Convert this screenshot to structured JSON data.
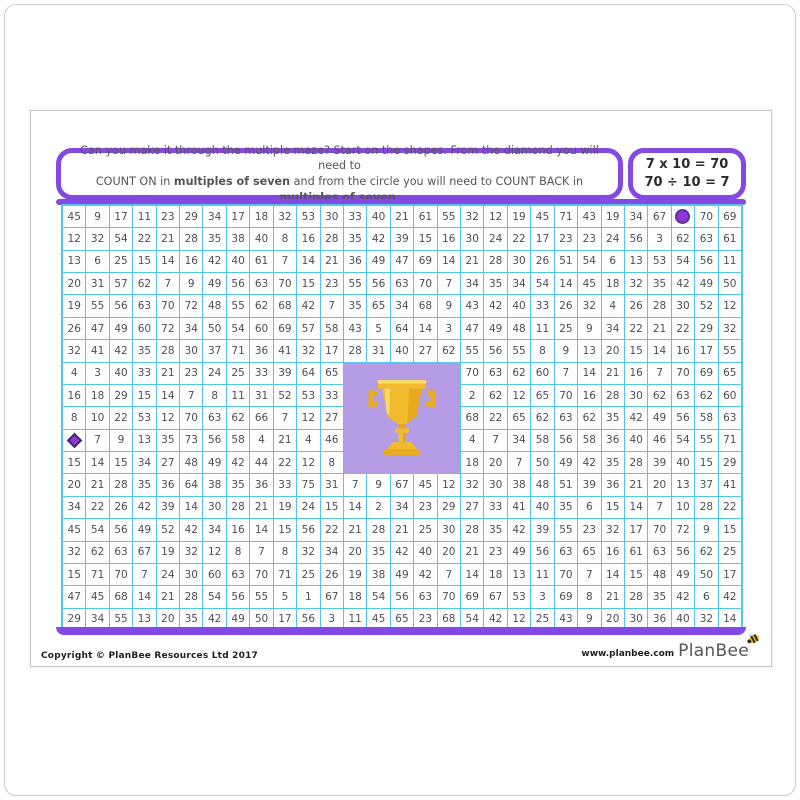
{
  "instructions": {
    "line1": "Can you make it through the multiple maze? Start on the shapes. From the diamond you will need to",
    "line2_pre": "COUNT ON in ",
    "line2_bold1": "multiples of seven",
    "line2_mid": " and from the circle you will need to COUNT BACK in ",
    "line2_bold2": "multiples of seven",
    "line2_end": "."
  },
  "equation_box": {
    "line1": "7 x 10 = 70",
    "line2": "70 ÷ 10 = 7"
  },
  "grid": {
    "columns": 29,
    "rows_count": 19,
    "circle_marker_cell": {
      "row": 1,
      "col": 27
    },
    "diamond_marker_cell": {
      "row": 11,
      "col": 1
    },
    "trophy_block": {
      "row_start": 8,
      "col_start": 13,
      "row_span": 5,
      "col_span": 5
    },
    "rows": [
      [
        "45",
        "9",
        "17",
        "11",
        "23",
        "29",
        "34",
        "17",
        "18",
        "32",
        "53",
        "30",
        "33",
        "40",
        "21",
        "61",
        "55",
        "32",
        "12",
        "19",
        "45",
        "71",
        "43",
        "19",
        "34",
        "67",
        "@circle",
        "70",
        "69"
      ],
      [
        "12",
        "32",
        "54",
        "22",
        "21",
        "28",
        "35",
        "38",
        "40",
        "8",
        "16",
        "28",
        "35",
        "42",
        "39",
        "15",
        "16",
        "30",
        "24",
        "22",
        "17",
        "23",
        "23",
        "24",
        "56",
        "3",
        "62",
        "63",
        "61"
      ],
      [
        "13",
        "6",
        "25",
        "15",
        "14",
        "16",
        "42",
        "40",
        "61",
        "7",
        "14",
        "21",
        "36",
        "49",
        "47",
        "69",
        "14",
        "21",
        "28",
        "30",
        "26",
        "51",
        "54",
        "6",
        "13",
        "53",
        "54",
        "56",
        "11"
      ],
      [
        "20",
        "31",
        "57",
        "62",
        "7",
        "9",
        "49",
        "56",
        "63",
        "70",
        "15",
        "23",
        "55",
        "56",
        "63",
        "70",
        "7",
        "34",
        "35",
        "34",
        "54",
        "14",
        "45",
        "18",
        "32",
        "35",
        "42",
        "49",
        "50"
      ],
      [
        "19",
        "55",
        "56",
        "63",
        "70",
        "72",
        "48",
        "55",
        "62",
        "68",
        "42",
        "7",
        "35",
        "65",
        "34",
        "68",
        "9",
        "43",
        "42",
        "40",
        "33",
        "26",
        "32",
        "4",
        "26",
        "28",
        "30",
        "52",
        "12"
      ],
      [
        "26",
        "47",
        "49",
        "60",
        "72",
        "34",
        "50",
        "54",
        "60",
        "69",
        "57",
        "58",
        "43",
        "5",
        "64",
        "14",
        "3",
        "47",
        "49",
        "48",
        "11",
        "25",
        "9",
        "34",
        "22",
        "21",
        "22",
        "29",
        "32"
      ],
      [
        "32",
        "41",
        "42",
        "35",
        "28",
        "30",
        "37",
        "71",
        "36",
        "41",
        "32",
        "17",
        "28",
        "31",
        "40",
        "27",
        "62",
        "55",
        "56",
        "55",
        "8",
        "9",
        "13",
        "20",
        "15",
        "14",
        "16",
        "17",
        "55"
      ],
      [
        "4",
        "3",
        "40",
        "33",
        "21",
        "23",
        "24",
        "25",
        "33",
        "39",
        "64",
        "65",
        null,
        null,
        null,
        null,
        null,
        "70",
        "63",
        "62",
        "60",
        "7",
        "14",
        "21",
        "16",
        "7",
        "70",
        "69",
        "65"
      ],
      [
        "16",
        "18",
        "29",
        "15",
        "14",
        "7",
        "8",
        "11",
        "31",
        "52",
        "53",
        "33",
        null,
        null,
        null,
        null,
        null,
        "2",
        "62",
        "12",
        "65",
        "70",
        "16",
        "28",
        "30",
        "62",
        "63",
        "62",
        "60"
      ],
      [
        "8",
        "10",
        "22",
        "53",
        "12",
        "70",
        "63",
        "62",
        "66",
        "7",
        "12",
        "27",
        null,
        null,
        null,
        null,
        null,
        "68",
        "22",
        "65",
        "62",
        "63",
        "62",
        "35",
        "42",
        "49",
        "56",
        "58",
        "63"
      ],
      [
        "@diamond",
        "7",
        "9",
        "13",
        "35",
        "73",
        "56",
        "58",
        "4",
        "21",
        "4",
        "46",
        null,
        null,
        null,
        null,
        null,
        "4",
        "7",
        "34",
        "58",
        "56",
        "58",
        "36",
        "40",
        "46",
        "54",
        "55",
        "71"
      ],
      [
        "15",
        "14",
        "15",
        "34",
        "27",
        "48",
        "49",
        "42",
        "44",
        "22",
        "12",
        "8",
        null,
        null,
        null,
        null,
        null,
        "18",
        "20",
        "7",
        "50",
        "49",
        "42",
        "35",
        "28",
        "39",
        "40",
        "15",
        "29"
      ],
      [
        "20",
        "21",
        "28",
        "35",
        "36",
        "64",
        "38",
        "35",
        "36",
        "33",
        "75",
        "31",
        "7",
        "9",
        "67",
        "45",
        "12",
        "32",
        "30",
        "38",
        "48",
        "51",
        "39",
        "36",
        "21",
        "20",
        "13",
        "37",
        "41"
      ],
      [
        "34",
        "22",
        "26",
        "42",
        "39",
        "14",
        "30",
        "28",
        "21",
        "19",
        "24",
        "15",
        "14",
        "2",
        "34",
        "23",
        "29",
        "27",
        "33",
        "41",
        "40",
        "35",
        "6",
        "15",
        "14",
        "7",
        "10",
        "28",
        "22"
      ],
      [
        "45",
        "54",
        "56",
        "49",
        "52",
        "42",
        "34",
        "16",
        "14",
        "15",
        "56",
        "22",
        "21",
        "28",
        "21",
        "25",
        "30",
        "28",
        "35",
        "42",
        "39",
        "55",
        "23",
        "32",
        "17",
        "70",
        "72",
        "9",
        "15"
      ],
      [
        "32",
        "62",
        "63",
        "67",
        "19",
        "32",
        "12",
        "8",
        "7",
        "8",
        "32",
        "34",
        "20",
        "35",
        "42",
        "40",
        "20",
        "21",
        "23",
        "49",
        "56",
        "63",
        "65",
        "16",
        "61",
        "63",
        "56",
        "62",
        "25"
      ],
      [
        "15",
        "71",
        "70",
        "7",
        "24",
        "30",
        "60",
        "63",
        "70",
        "71",
        "25",
        "26",
        "19",
        "38",
        "49",
        "42",
        "7",
        "14",
        "18",
        "13",
        "11",
        "70",
        "7",
        "14",
        "15",
        "48",
        "49",
        "50",
        "17"
      ],
      [
        "47",
        "45",
        "68",
        "14",
        "21",
        "28",
        "54",
        "56",
        "55",
        "5",
        "1",
        "67",
        "18",
        "54",
        "56",
        "63",
        "70",
        "69",
        "67",
        "53",
        "3",
        "69",
        "8",
        "21",
        "28",
        "35",
        "42",
        "6",
        "42"
      ],
      [
        "29",
        "34",
        "55",
        "13",
        "20",
        "35",
        "42",
        "49",
        "50",
        "17",
        "56",
        "3",
        "11",
        "45",
        "65",
        "23",
        "68",
        "54",
        "42",
        "12",
        "25",
        "43",
        "9",
        "20",
        "30",
        "36",
        "40",
        "32",
        "14"
      ]
    ]
  },
  "footer": {
    "copyright": "Copyright © PlanBee Resources Ltd 2017",
    "website": "www.planbee.com",
    "brand": "PlanBee"
  },
  "colors": {
    "purple_border": "#8549e3",
    "grid_line_cyan": "#54c6e8",
    "trophy_background_lavender": "#b69ce4",
    "trophy_gold": "#f2bb2e",
    "marker_purple": "#8f36d6",
    "number_text": "#4f4f4f"
  },
  "icons": {
    "trophy": "trophy-icon",
    "bee": "bee-icon",
    "circle_start": "circle-start-marker",
    "diamond_start": "diamond-start-marker"
  }
}
